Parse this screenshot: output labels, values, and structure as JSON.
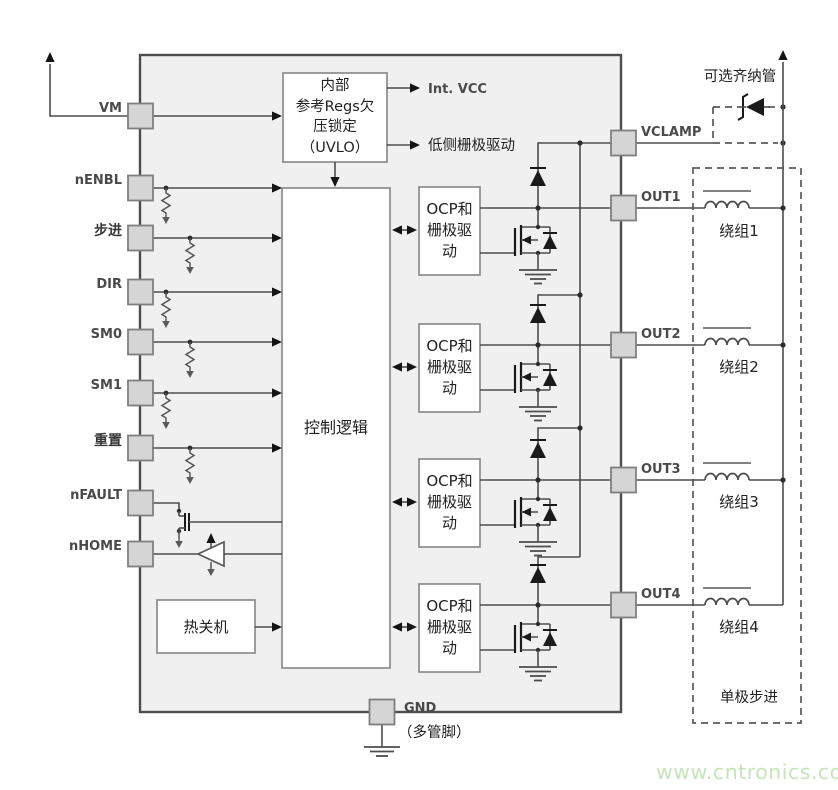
{
  "device": {
    "kind": "unipolar-stepper-driver-block-diagram"
  },
  "pins": {
    "left": [
      "VM",
      "nENBL",
      "步进",
      "DIR",
      "SM0",
      "SM1",
      "重置",
      "nFAULT",
      "nHOME"
    ],
    "right": [
      "VCLAMP",
      "OUT1",
      "OUT2",
      "OUT3",
      "OUT4"
    ],
    "ground": {
      "label": "GND",
      "note": "（多管脚）"
    }
  },
  "blocks": {
    "uvlo": {
      "lines": [
        "内部",
        "参考Regs欠",
        "压锁定",
        "（UVLO）"
      ]
    },
    "uvlo_outputs": [
      "Int. VCC",
      "低侧栅极驱动"
    ],
    "control_logic": "控制逻辑",
    "thermal_shutdown": "热关机",
    "ocp_driver": {
      "lines": [
        "OCP和",
        "栅极驱",
        "动"
      ]
    }
  },
  "motor": {
    "zener_label": "可选齐纳管",
    "windings": [
      "绕组1",
      "绕组2",
      "绕组3",
      "绕组4"
    ],
    "type_label": "单极步进"
  },
  "watermark": {
    "text": "www.cntronics.com",
    "color": "#c5e5b8"
  },
  "colors": {
    "ic_fill": "#f0f0f0",
    "ic_border": "#4d4d4d",
    "wire": "#4d4d4d",
    "pad_fill": "#d5d5d5",
    "pad_border": "#7f7f7f",
    "block_border": "#8c8c8c",
    "text": "#222222",
    "arrow": "#141414"
  }
}
